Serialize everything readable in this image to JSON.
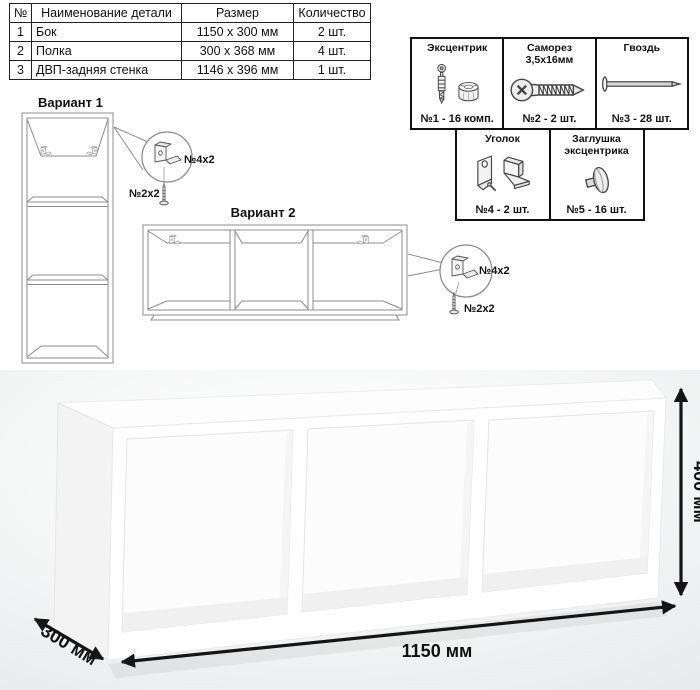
{
  "parts_table": {
    "headers": {
      "num": "№",
      "name": "Наименование детали",
      "size": "Размер",
      "qty": "Количество"
    },
    "rows": [
      {
        "num": "1",
        "name": "Бок",
        "size": "1150 х 300 мм",
        "qty": "2 шт."
      },
      {
        "num": "2",
        "name": "Полка",
        "size": "300 х 368 мм",
        "qty": "4 шт."
      },
      {
        "num": "3",
        "name": "ДВП-задняя стенка",
        "size": "1146 х 396 мм",
        "qty": "1 шт."
      }
    ]
  },
  "hardware_box": {
    "items": [
      {
        "name": "Эксцентрик",
        "count": "№1 - 16 комп.",
        "icon": "cam-bolt-icon"
      },
      {
        "name": "Саморез 3,5х16мм",
        "count": "№2 - 2 шт.",
        "icon": "screw-icon"
      },
      {
        "name": "Гвоздь",
        "count": "№3 - 28 шт.",
        "icon": "nail-icon"
      },
      {
        "name": "Уголок",
        "count": "№4 - 2 шт.",
        "icon": "corner-bracket-icon"
      },
      {
        "name": "Заглушка эксцентрика",
        "count": "№5 - 16 шт.",
        "icon": "cam-cap-icon"
      }
    ]
  },
  "variant1": {
    "title": "Вариант 1",
    "bracket_label": "№4х2",
    "screw_label": "№2х2"
  },
  "variant2": {
    "title": "Вариант 2",
    "bracket_label": "№4х2",
    "screw_label": "№2х2"
  },
  "dimensions": {
    "height": "400 мм",
    "width": "1150 мм",
    "depth": "300 мм"
  },
  "colors": {
    "line_gray": "#8c8c8c",
    "text": "#111111",
    "photo_bg": "#eceded",
    "arrow": "#151515"
  }
}
